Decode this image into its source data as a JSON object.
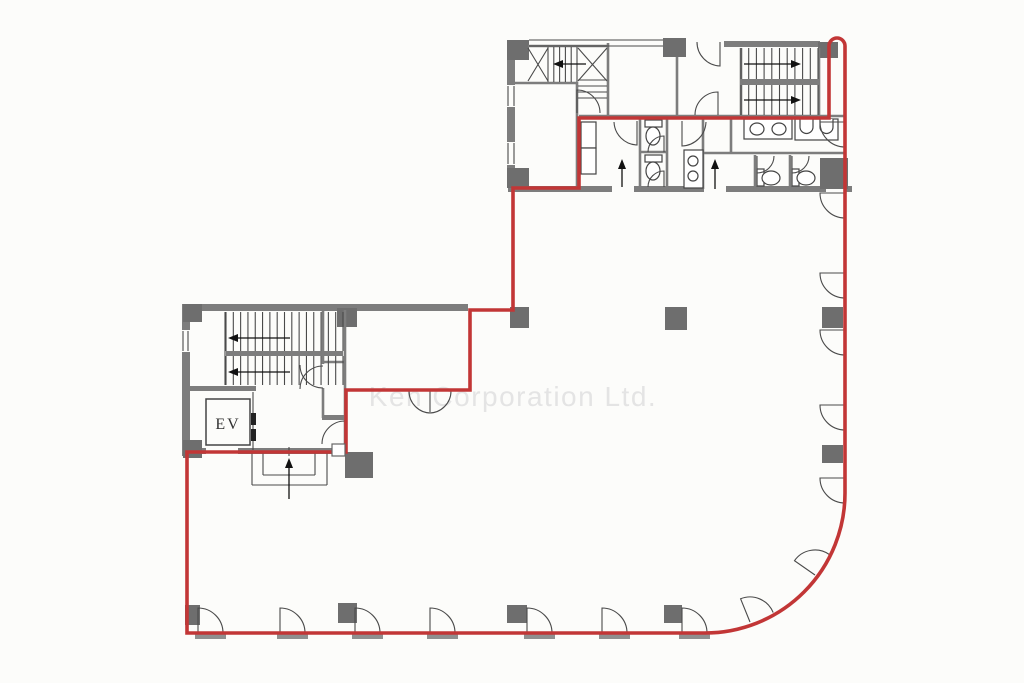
{
  "meta": {
    "title": "Office building floor plan",
    "canvas_w": 1024,
    "canvas_h": 683
  },
  "watermark": {
    "text": "Ken Corporation Ltd.",
    "color": "#e4e4e4",
    "x": 513,
    "y": 406
  },
  "labels": {
    "elevator": "EV",
    "elevator_x": 228,
    "elevator_y": 429
  },
  "colors": {
    "background": "#fcfcfa",
    "wall": "#7d7d7d",
    "column": "#6e6e6e",
    "line": "#4a4a4a",
    "fixture": "#444444",
    "red": "#c23636",
    "sill": "#8f8f8f",
    "arrow": "#111111",
    "dark": "#222222"
  },
  "geometry": {
    "red_outline": "M187,452 L187,633 L705,633 A140,140 0 0 0 845,493 L845,46 A8,8 0 0 0 837,38 A8,8 0 0 0 829,46 L829,118 L579,118 L579,188 L513,188 L513,310 L470,310 L470,390 L346,390 L346,452 Z",
    "wall_rects": [
      [
        724,
        41,
        96,
        6
      ],
      [
        507,
        40,
        8,
        148
      ],
      [
        508,
        186,
        104,
        6
      ],
      [
        634,
        186,
        70,
        6
      ],
      [
        726,
        186,
        100,
        6
      ],
      [
        846,
        186,
        6,
        6
      ],
      [
        741,
        79,
        77,
        6
      ],
      [
        182,
        304,
        286,
        7
      ],
      [
        182,
        304,
        8,
        152
      ],
      [
        182,
        448,
        165,
        6
      ],
      [
        190,
        386,
        66,
        5
      ],
      [
        226,
        351,
        117,
        5
      ],
      [
        322,
        415,
        25,
        5
      ]
    ],
    "white_rects": [
      [
        506,
        85,
        10,
        22
      ],
      [
        506,
        142,
        10,
        23
      ],
      [
        181,
        330,
        9,
        22
      ],
      [
        206,
        448,
        32,
        6
      ]
    ],
    "columns": [
      [
        507,
        40,
        22,
        20
      ],
      [
        663,
        38,
        23,
        19
      ],
      [
        818,
        42,
        20,
        16
      ],
      [
        507,
        168,
        22,
        20
      ],
      [
        183,
        304,
        19,
        18
      ],
      [
        337,
        308,
        20,
        19
      ],
      [
        183,
        440,
        19,
        18
      ],
      [
        345,
        452,
        28,
        26
      ],
      [
        510,
        307,
        19,
        21
      ],
      [
        665,
        307,
        22,
        23
      ],
      [
        822,
        307,
        21,
        21
      ],
      [
        822,
        445,
        21,
        18
      ],
      [
        185,
        605,
        15,
        20
      ],
      [
        338,
        603,
        19,
        20
      ],
      [
        507,
        605,
        20,
        18
      ],
      [
        664,
        605,
        18,
        18
      ],
      [
        820,
        158,
        28,
        31
      ]
    ],
    "wall_lines": [
      [
        608,
        43,
        608,
        118
      ],
      [
        677,
        57,
        677,
        115
      ],
      [
        577,
        82,
        577,
        190
      ],
      [
        512,
        83,
        577,
        83
      ],
      [
        579,
        116,
        845,
        116
      ],
      [
        640,
        119,
        640,
        189
      ],
      [
        667,
        119,
        667,
        189
      ],
      [
        703,
        119,
        703,
        189
      ],
      [
        731,
        119,
        731,
        153
      ],
      [
        703,
        153,
        845,
        153
      ],
      [
        755,
        155,
        755,
        189
      ],
      [
        790,
        155,
        790,
        189
      ],
      [
        640,
        152,
        667,
        152
      ],
      [
        741,
        48,
        741,
        115
      ],
      [
        819,
        48,
        819,
        115
      ],
      [
        323,
        310,
        323,
        364
      ],
      [
        323,
        388,
        323,
        418
      ],
      [
        345,
        310,
        345,
        452
      ],
      [
        323,
        362,
        345,
        362
      ],
      [
        528,
        46,
        608,
        46
      ]
    ],
    "thin_lines": [
      [
        508,
        86,
        508,
        106
      ],
      [
        514,
        86,
        514,
        106
      ],
      [
        508,
        143,
        508,
        164
      ],
      [
        514,
        143,
        514,
        164
      ],
      [
        529,
        40,
        663,
        40
      ],
      [
        529,
        46,
        663,
        46
      ],
      [
        183,
        331,
        183,
        351
      ],
      [
        188,
        331,
        188,
        351
      ],
      [
        528,
        48,
        548,
        81
      ],
      [
        548,
        48,
        528,
        81
      ],
      [
        578,
        48,
        607,
        81
      ],
      [
        607,
        48,
        578,
        81
      ],
      [
        225,
        312,
        225,
        385
      ],
      [
        252,
        452,
        252,
        485
      ],
      [
        252,
        485,
        327,
        485
      ],
      [
        327,
        452,
        327,
        485
      ],
      [
        263,
        452,
        263,
        475
      ],
      [
        263,
        475,
        315,
        475
      ],
      [
        315,
        452,
        315,
        475
      ],
      [
        289,
        447,
        289,
        456
      ],
      [
        253,
        392,
        253,
        450
      ],
      [
        430,
        391,
        430,
        412
      ],
      [
        816,
        119,
        816,
        139
      ]
    ],
    "stair_runs": [
      {
        "d": "v",
        "x1": 548,
        "x2": 577,
        "n": 6,
        "a": 47,
        "b": 82
      },
      {
        "d": "h",
        "y1": 80,
        "y2": 98,
        "n": 4,
        "a": 578,
        "b": 607
      },
      {
        "d": "v",
        "x1": 741,
        "x2": 818,
        "n": 11,
        "a": 48,
        "b": 79
      },
      {
        "d": "v",
        "x1": 741,
        "x2": 818,
        "n": 11,
        "a": 85,
        "b": 115
      },
      {
        "d": "v",
        "x1": 226,
        "x2": 343,
        "n": 17,
        "a": 312,
        "b": 351
      },
      {
        "d": "v",
        "x1": 226,
        "x2": 343,
        "n": 17,
        "a": 356,
        "b": 385
      }
    ],
    "door_arcs": [
      "M198,633 L198,608 A25,25 0 0 1 223,633",
      "M280,633 L280,608 A25,25 0 0 1 305,633",
      "M355,633 L355,608 A25,25 0 0 1 380,633",
      "M430,633 L430,608 A25,25 0 0 1 455,633",
      "M527,633 L527,608 A25,25 0 0 1 552,633",
      "M602,633 L602,608 A25,25 0 0 1 627,633",
      "M682,633 L682,608 A25,25 0 0 1 707,633",
      "M750,622 L740.6,598.8 A25,25 0 0 1 773.2,612.6",
      "M815,575 L794.5,560.7 A25,25 0 0 1 829.3,554.5",
      "M845,193 L820,193 A25,25 0 0 0 845,218",
      "M845,273 L820,273 A25,25 0 0 0 845,298",
      "M845,330 L820,330 A25,25 0 0 0 845,355",
      "M845,405 L820,405 A25,25 0 0 0 845,430",
      "M845,478 L820,478 A25,25 0 0 0 845,503",
      "M577,113 L577,90 A23,23 0 0 1 600,113",
      "M720,42 L720,66 A24,24 0 0 1 697,42",
      "M718,115 L718,92 A23,23 0 0 0 695,115",
      "M637,121 L637,145 A24,24 0 0 1 614,122",
      "M682,121 L682,146 A25,25 0 0 0 706,122",
      "M845,122 L820,122 A25,25 0 0 0 845,147",
      "M757,156 L757,173 A17,17 0 0 0 774,156",
      "M792,156 L792,173 A17,17 0 0 0 809,156",
      "M664,152 L664,136 A16,16 0 0 0 648,152",
      "M664,187 L664,171 A16,16 0 0 0 648,187",
      "M300,365 A23,23 0 0 0 323,388",
      "M300,389 A23,23 0 0 1 323,366",
      "M345,444 L345,421 A23,23 0 0 0 322,444",
      "M409,391 A22,22 0 0 0 431,413",
      "M451,391 A22,22 0 0 1 429,413"
    ],
    "sills": [
      [
        195,
        634,
        31,
        5
      ],
      [
        277,
        634,
        31,
        5
      ],
      [
        352,
        634,
        31,
        5
      ],
      [
        427,
        634,
        31,
        5
      ],
      [
        524,
        634,
        31,
        5
      ],
      [
        599,
        634,
        31,
        5
      ],
      [
        679,
        634,
        31,
        5
      ]
    ],
    "outline_boxes": [
      [
        744,
        119,
        48,
        20
      ],
      [
        795,
        119,
        43,
        21
      ],
      [
        684,
        150,
        19,
        38
      ],
      [
        581,
        122,
        15,
        26
      ],
      [
        581,
        148,
        15,
        26
      ],
      [
        645,
        120,
        17,
        7
      ],
      [
        645,
        155,
        17,
        7
      ],
      [
        757,
        169,
        7,
        17
      ],
      [
        792,
        169,
        7,
        17
      ]
    ],
    "frames": [
      [
        206,
        399,
        44,
        46
      ]
    ],
    "ellipses": [
      [
        757,
        129,
        7,
        6
      ],
      [
        779,
        129,
        7,
        6
      ],
      [
        653,
        136,
        7,
        9
      ],
      [
        653,
        171,
        7,
        9
      ],
      [
        771,
        178,
        9,
        7
      ],
      [
        806,
        178,
        9,
        7
      ]
    ],
    "circles": [
      [
        693,
        161,
        5
      ],
      [
        693,
        176,
        5
      ]
    ],
    "urinal_paths": [
      "M800,119 v8 a6.5,6.5 0 0 0 13,0 v-8",
      "M820,119 v8 a6.5,6.5 0 0 0 13,0 v-8"
    ],
    "dark_rects": [
      [
        251,
        413,
        5,
        12
      ],
      [
        251,
        429,
        5,
        12
      ]
    ],
    "arrows": [
      [
        586,
        64,
        553,
        64
      ],
      [
        744,
        64,
        801,
        64
      ],
      [
        744,
        100,
        801,
        100
      ],
      [
        622,
        187,
        622,
        159
      ],
      [
        715,
        189,
        715,
        159
      ],
      [
        290,
        338,
        228,
        338
      ],
      [
        290,
        372,
        228,
        372
      ],
      [
        289,
        499,
        289,
        458
      ]
    ],
    "over_red_boxes": [
      [
        332,
        444,
        13,
        12
      ]
    ]
  }
}
